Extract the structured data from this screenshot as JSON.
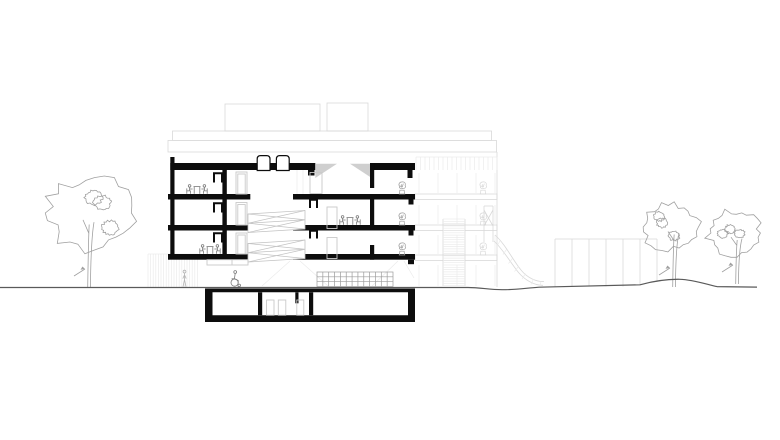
{
  "meta": {
    "label": "Architectural cross-section drawing of a multi-storey building with basement, scissor stair, roof boxes, trees, slide and garden fence",
    "type": "architectural-section"
  },
  "colors": {
    "paper": "#ffffff",
    "cut": "#0d0d0d",
    "ground": "#5a5a5a",
    "figure": "#7a7a7a",
    "figureLight": "#b5b5b5",
    "tree": "#a0a0a0",
    "stair": "#c3c3c3",
    "door": "#c9c9c9",
    "light": "#d9d9d9",
    "lighter": "#ebebeb",
    "wedge": "#cfcfcf",
    "shelf": "#9b9b9b",
    "plant": "#9e9e9e"
  },
  "scene": {
    "trees": [
      {
        "cx": 90,
        "cy": 213,
        "r": 46,
        "trunk": 89,
        "ground": 288,
        "seed": 3
      },
      {
        "cx": 671,
        "cy": 227,
        "r": 30,
        "trunk": 674,
        "ground": 287,
        "seed": 7
      },
      {
        "cx": 734,
        "cy": 233,
        "r": 28,
        "trunk": 737,
        "ground": 284,
        "seed": 11
      }
    ],
    "figures": [
      {
        "glyph": "table-group",
        "name": "table-with-two-people",
        "x": 183,
        "y": 184
      },
      {
        "glyph": "table-group",
        "name": "table-with-two-people",
        "x": 196,
        "y": 244
      },
      {
        "glyph": "table-group",
        "name": "table-with-two-people",
        "x": 336,
        "y": 215
      },
      {
        "glyph": "person-standing",
        "name": "standing-person",
        "x": 181,
        "y": 270
      },
      {
        "glyph": "person-wheelchair",
        "name": "wheelchair-person",
        "x": 229,
        "y": 270
      },
      {
        "glyph": "plant",
        "name": "balcony-plant",
        "x": 397,
        "y": 181
      },
      {
        "glyph": "plant",
        "name": "balcony-plant",
        "x": 397,
        "y": 212
      },
      {
        "glyph": "plant",
        "name": "balcony-plant",
        "x": 397,
        "y": 242
      },
      {
        "glyph": "plant-bg",
        "name": "background-balcony-plant",
        "x": 478,
        "y": 181
      },
      {
        "glyph": "plant-bg",
        "name": "background-balcony-plant",
        "x": 478,
        "y": 212
      },
      {
        "glyph": "plant-bg",
        "name": "background-balcony-plant",
        "x": 478,
        "y": 242
      }
    ],
    "fence": {
      "x": 555,
      "top": 239,
      "count": 7,
      "step": 17
    },
    "stripeWall": {
      "x": 148,
      "y": 254,
      "w": 50,
      "h": 33,
      "step": 2.6
    },
    "stairHatch": {
      "x": 443,
      "y": 219,
      "w": 22,
      "h": 67,
      "step": 2.3
    },
    "railing": {
      "x": 416,
      "y": 157,
      "w": 81,
      "h": 13,
      "step": 4.5
    },
    "glazing": {
      "x": 419,
      "w": 76,
      "step": 19,
      "zones": [
        [
          173,
          193
        ],
        [
          205,
          224
        ],
        [
          235,
          254
        ],
        [
          265,
          286
        ]
      ]
    },
    "shelf": {
      "x": 317,
      "y": 272,
      "w": 76,
      "h": 14.5,
      "rows": 3,
      "cols": 13
    }
  }
}
